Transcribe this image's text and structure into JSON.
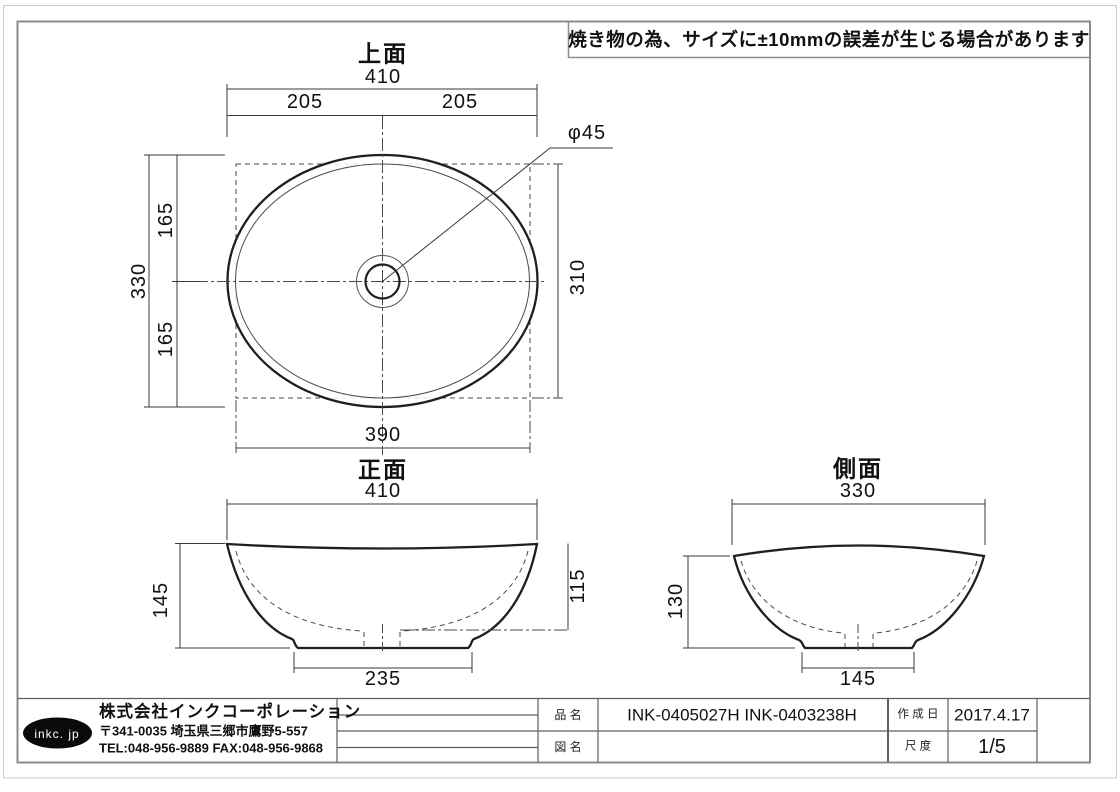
{
  "note": "焼き物の為、サイズに±10mmの誤差が生じる場合があります",
  "views": {
    "top": {
      "title": "上面",
      "width_total": "410",
      "width_half_left": "205",
      "width_half_right": "205",
      "height_total": "330",
      "height_half_top": "165",
      "height_half_bottom": "165",
      "inner_width": "390",
      "inner_height": "310",
      "drain_diameter": "φ45"
    },
    "front": {
      "title": "正面",
      "width": "410",
      "height": "145",
      "inner_depth": "115",
      "base_width": "235"
    },
    "side": {
      "title": "側面",
      "width": "330",
      "height": "130",
      "base_width": "145"
    }
  },
  "title_block": {
    "logo_text": "inkc. jp",
    "company_name": "株式会社インクコーポレーション",
    "company_address": "〒341-0035 埼玉県三郷市鷹野5-557",
    "company_tel_fax": "TEL:048-956-9889  FAX:048-956-9868",
    "product_label": "品 名",
    "product_value": "INK-0405027H  INK-0403238H",
    "drawing_name_label": "図 名",
    "drawing_name_value": "",
    "date_label": "作 成 日",
    "date_value": "2017.4.17",
    "scale_label": "尺 度",
    "scale_value": "1/5"
  },
  "colors": {
    "line": "#1f1f1f",
    "dim_line": "#3a3a3a",
    "frame": "#8c8c8c",
    "table_line": "#5f5f5f",
    "logo_fill": "#0a0a0a"
  }
}
